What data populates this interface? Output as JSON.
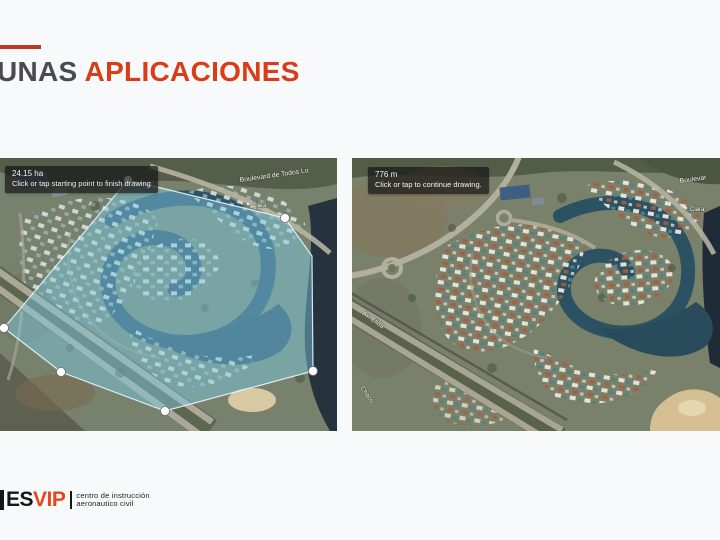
{
  "slide": {
    "title": {
      "prefix": "UNAS",
      "accent": "APLICACIONES"
    }
  },
  "maps": {
    "left": {
      "tooltip": {
        "measurement": "24.15 ha",
        "instruction": "Click or tap starting point to finish drawing"
      },
      "labels": {
        "boulevard": "Boulevard de Todos Lo",
        "street": "Clara"
      }
    },
    "right": {
      "tooltip": {
        "measurement": "776 m",
        "instruction": "Click or tap to continue drawing."
      },
      "labels": {
        "boulevard": "Boulevar",
        "street": "Clara",
        "avenue": "Av. Elida",
        "road": "Chaco"
      }
    }
  },
  "footer": {
    "logo": {
      "black": "ES",
      "accent": "VIP"
    },
    "caption": {
      "line1": "centro de instrucción",
      "line2": "aeronautico civil"
    }
  },
  "colors": {
    "title_accent": "#D93D17",
    "title_dark": "#4A4A52",
    "logo_accent": "#E8451D",
    "overlay_fill": "#7FCDE6"
  }
}
